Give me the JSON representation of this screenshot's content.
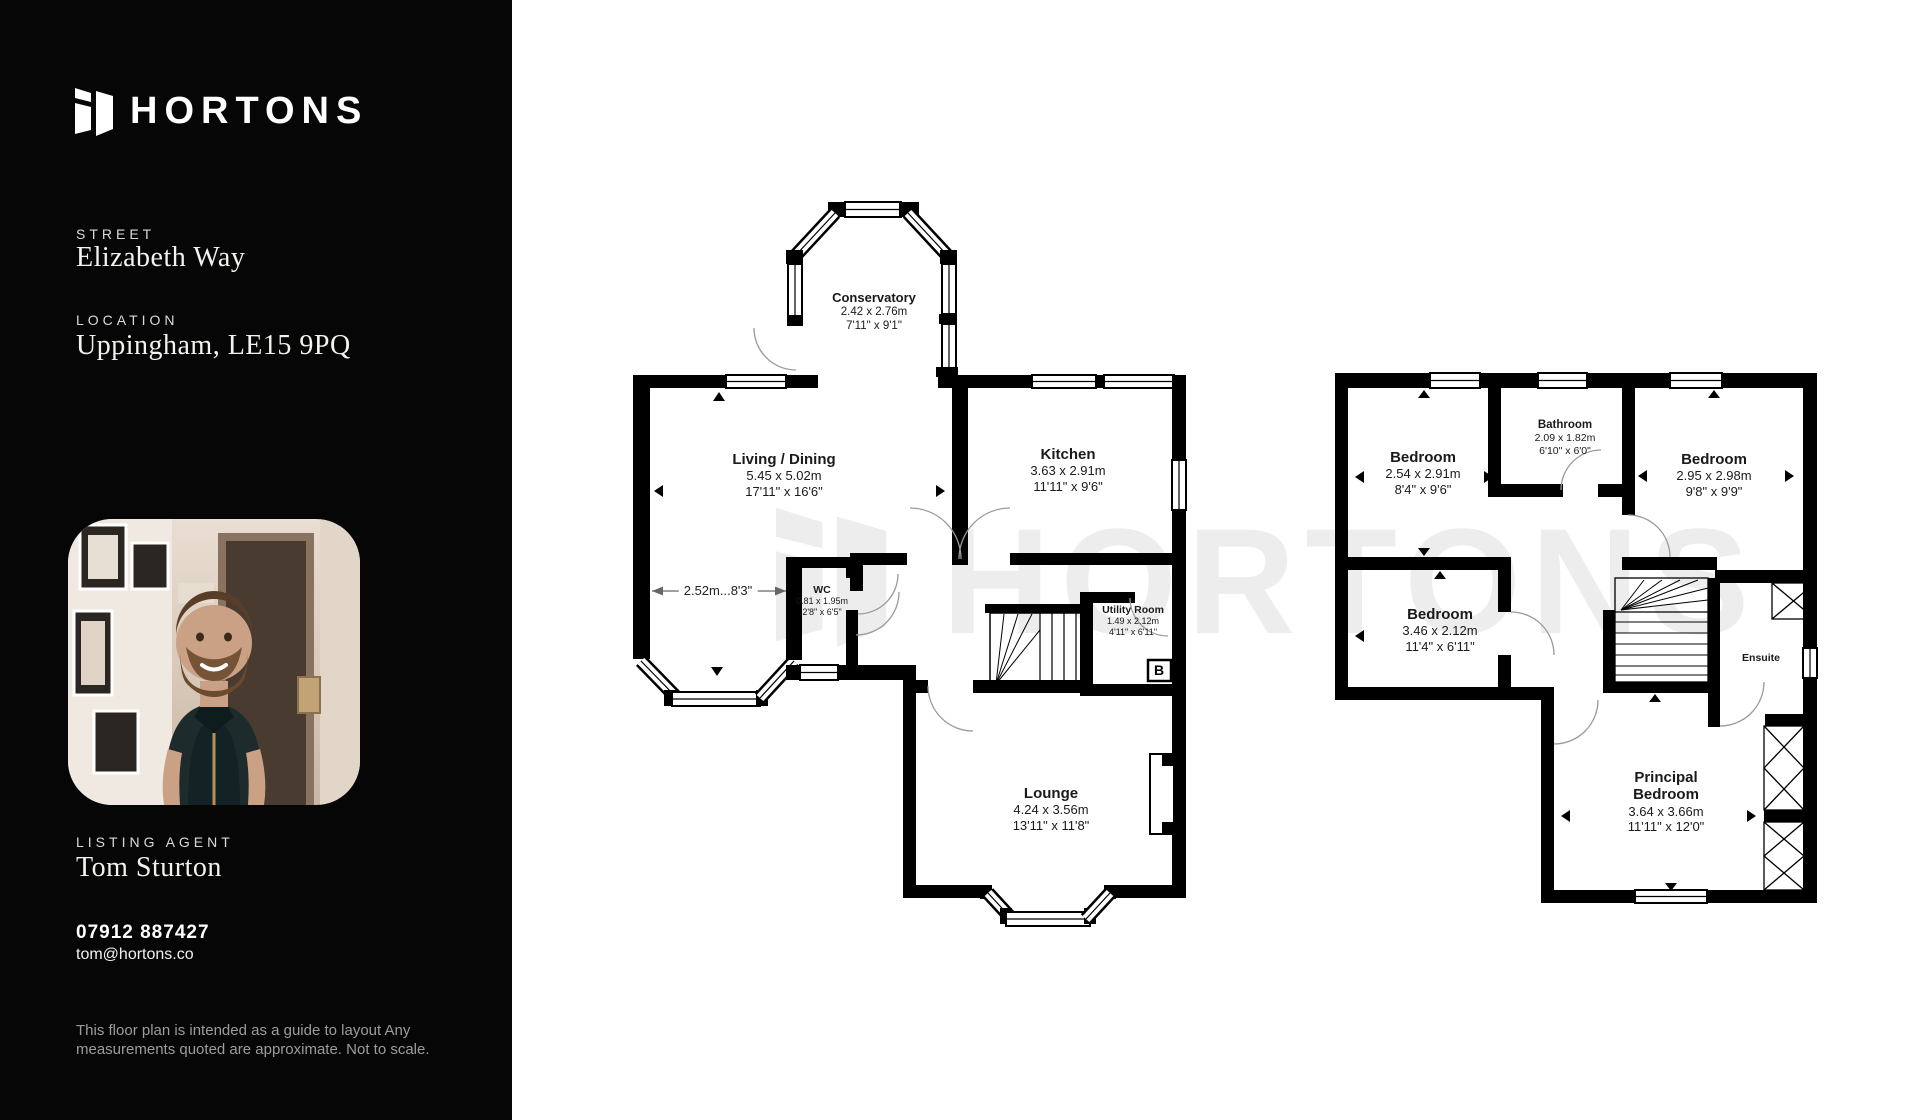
{
  "brand": {
    "name": "HORTONS"
  },
  "sidebar": {
    "street_label": "STREET",
    "street_value": "Elizabeth Way",
    "location_label": "LOCATION",
    "location_value": "Uppingham, LE15 9PQ",
    "agent_label": "LISTING AGENT",
    "agent_name": "Tom Sturton",
    "agent_phone": "07912 887427",
    "agent_email": "tom@hortons.co",
    "disclaimer": "This floor plan is intended as a guide to layout Any measurements quoted are approximate. Not to scale."
  },
  "watermark": {
    "text": "HORTONS"
  },
  "ground_floor": {
    "dimension_note": "2.52m...8'3\"",
    "boiler_label": "B",
    "rooms": {
      "conservatory": {
        "name": "Conservatory",
        "metric": "2.42 x 2.76m",
        "imperial": "7'11\" x 9'1\""
      },
      "living_dining": {
        "name": "Living / Dining",
        "metric": "5.45 x 5.02m",
        "imperial": "17'11\" x 16'6\""
      },
      "kitchen": {
        "name": "Kitchen",
        "metric": "3.63 x 2.91m",
        "imperial": "11'11\" x 9'6\""
      },
      "wc": {
        "name": "WC",
        "metric": "0.81 x 1.95m",
        "imperial": "2'8\" x 6'5\""
      },
      "utility": {
        "name": "Utility Room",
        "metric": "1.49 x 2.12m",
        "imperial": "4'11\" x 6'11\""
      },
      "lounge": {
        "name": "Lounge",
        "metric": "4.24 x 3.56m",
        "imperial": "13'11\" x 11'8\""
      }
    }
  },
  "first_floor": {
    "rooms": {
      "bedroom_top_left": {
        "name": "Bedroom",
        "metric": "2.54 x 2.91m",
        "imperial": "8'4\" x 9'6\""
      },
      "bathroom": {
        "name": "Bathroom",
        "metric": "2.09 x 1.82m",
        "imperial": "6'10\" x 6'0\""
      },
      "bedroom_top_right": {
        "name": "Bedroom",
        "metric": "2.95 x 2.98m",
        "imperial": "9'8\" x 9'9\""
      },
      "bedroom_middle": {
        "name": "Bedroom",
        "metric": "3.46 x 2.12m",
        "imperial": "11'4\" x 6'11\""
      },
      "ensuite": {
        "name": "Ensuite"
      },
      "principal_bedroom": {
        "name": "Principal Bedroom",
        "metric": "3.64 x 3.66m",
        "imperial": "11'11\" x 12'0\""
      }
    }
  },
  "colors": {
    "sidebar_bg": "#060606",
    "wall": "#000000",
    "watermark": "#ededed",
    "text": "#1a1a1a"
  }
}
